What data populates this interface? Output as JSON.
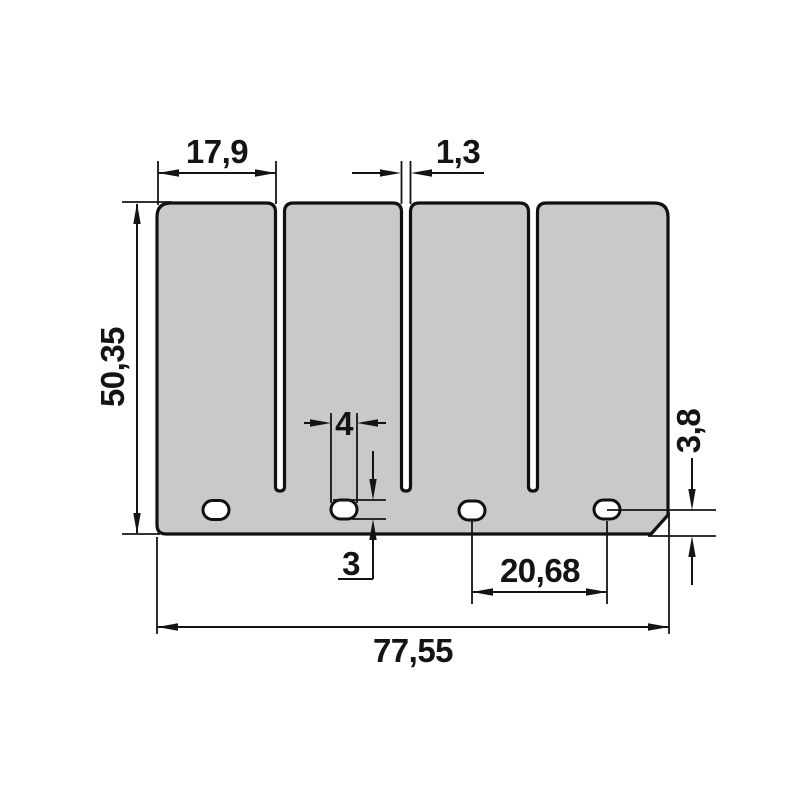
{
  "drawing": {
    "title": "reed-valve-petal-dimension-drawing",
    "style": "engineering-dimension-drawing",
    "decimal_separator": "comma",
    "colors": {
      "background": "#ffffff",
      "plate_fill": "#c9c9c9",
      "outline": "#111111",
      "dimension": "#141414"
    },
    "dimensions": {
      "finger_width": "17,9",
      "slot_width": "1,3",
      "plate_height": "50,35",
      "hole_width": "4",
      "hole_height": "3",
      "hole_center_to_bottom_edge": "3,8",
      "hole_spacing": "20,68",
      "total_width": "77,55"
    }
  }
}
